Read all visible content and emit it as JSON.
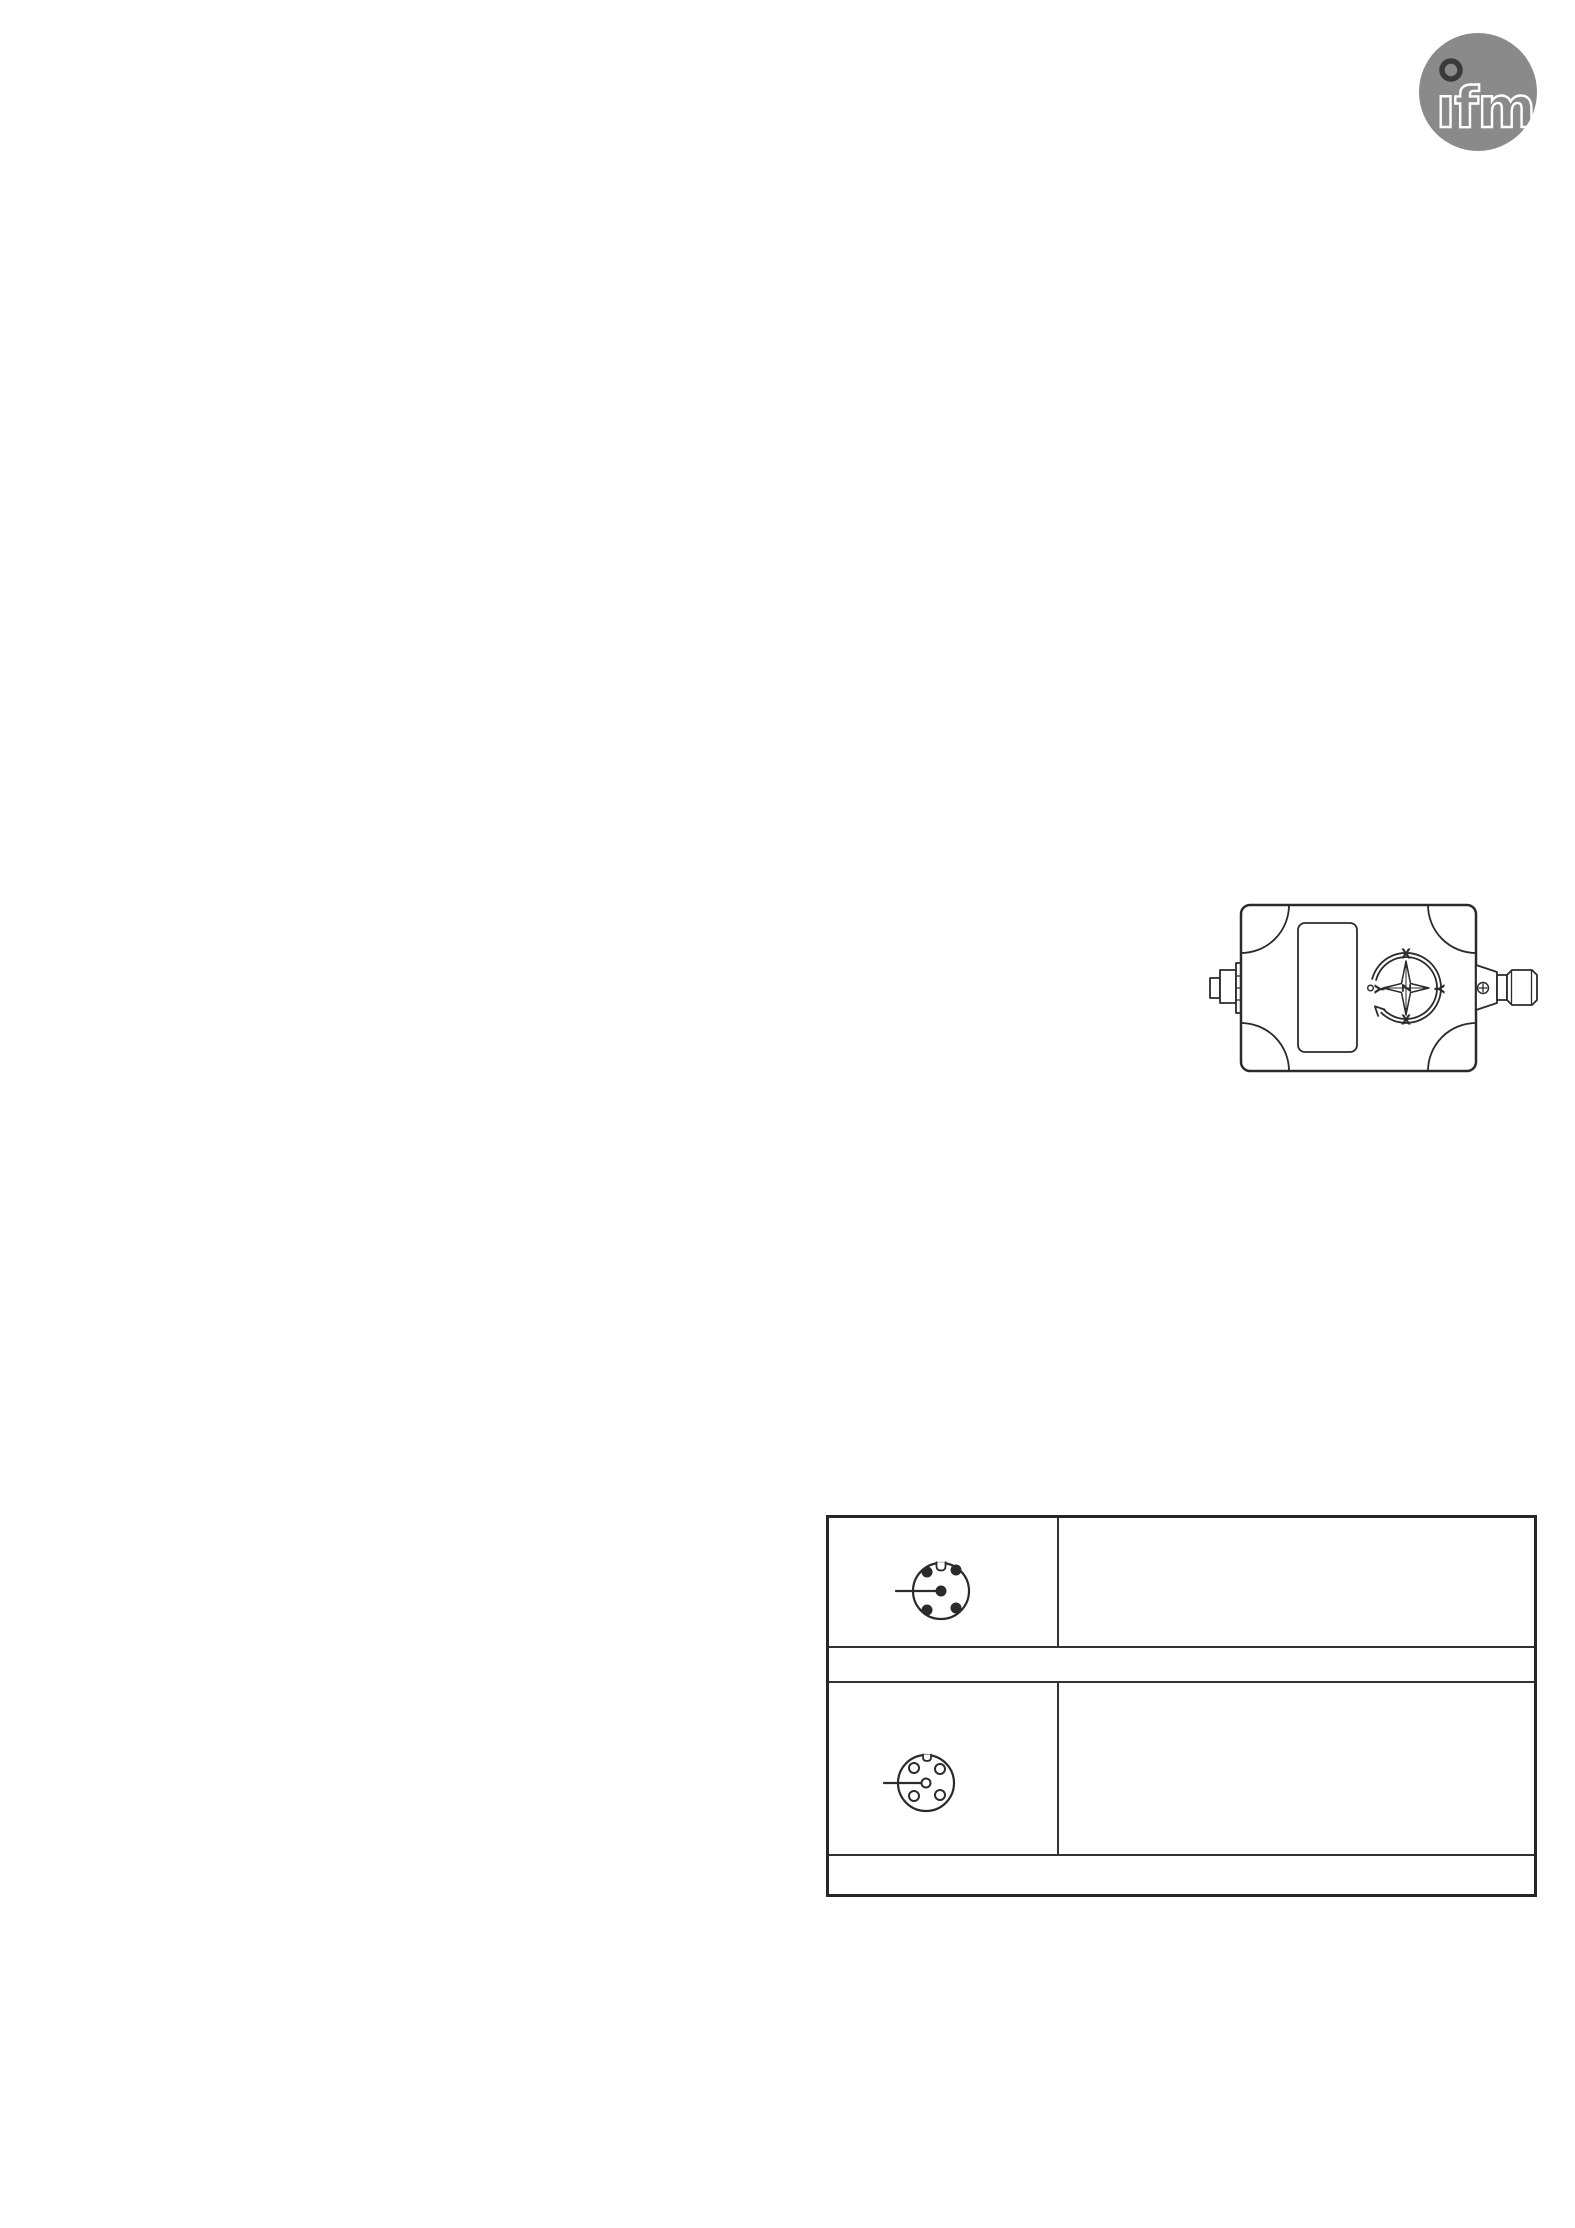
{
  "page": {
    "kind": "datasheet-page",
    "background": "#ffffff",
    "line_color": "#2b2b2b"
  },
  "logo": {
    "text": "ifm",
    "glyphs": "ıfm",
    "circle_color": "#8a8a8a",
    "letter_color": "#ffffff",
    "dot_ring_color": "#3a3a3a"
  },
  "device": {
    "description": "technical line drawing of sensor housing with M12 connector, label plate and axis compass rose",
    "compass": {
      "top_label": "X",
      "bottom_label": "X",
      "left_label": "Y",
      "right_label": "Y",
      "center_label": "Z"
    }
  },
  "connection_table": {
    "row1": {
      "icon": "m12-connector-male-5pin",
      "description_text": ""
    },
    "row2": {
      "text": ""
    },
    "row3": {
      "icon": "m12-connector-female-5pin",
      "description_text": ""
    },
    "row4": {
      "text": ""
    }
  }
}
